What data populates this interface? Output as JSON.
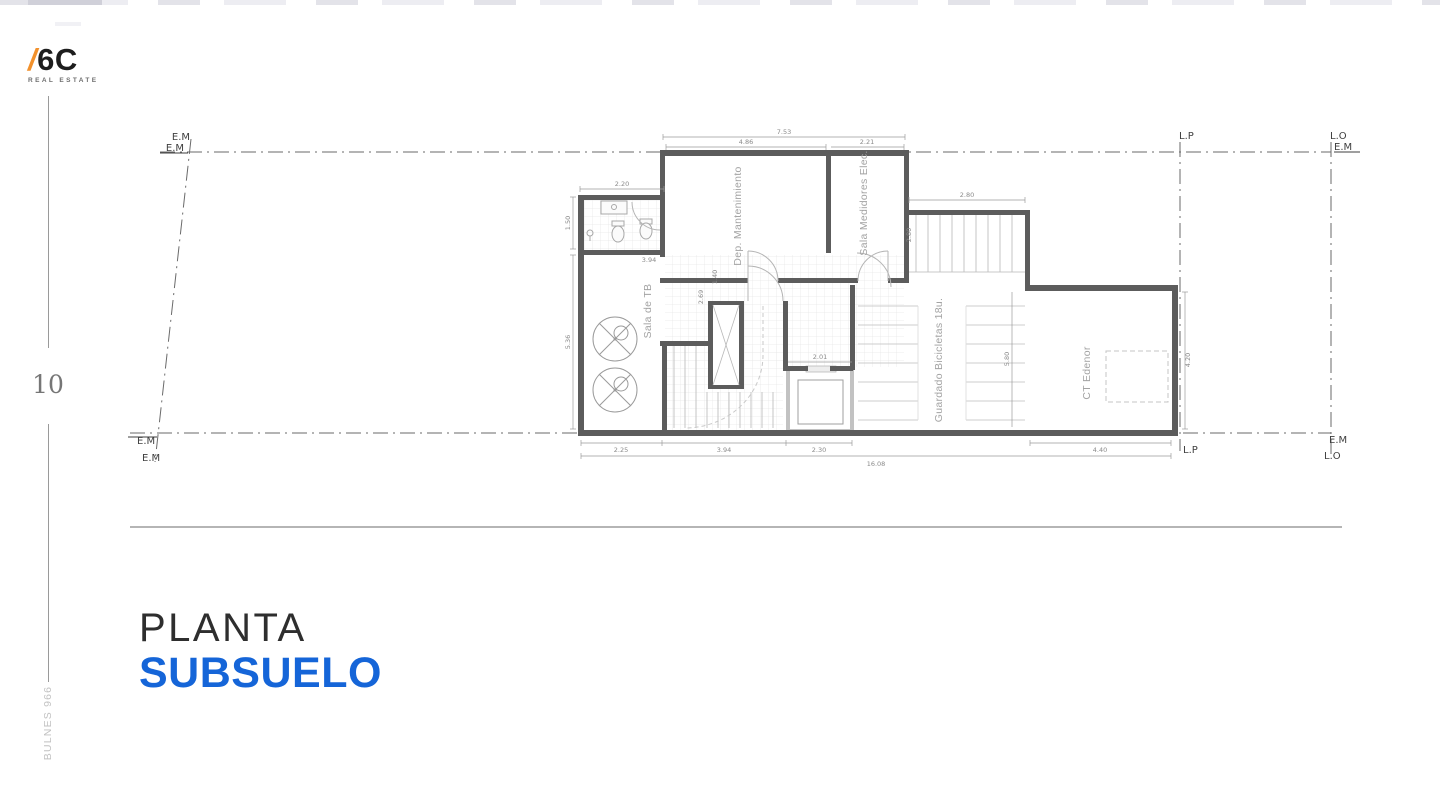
{
  "brand": {
    "slash": "/",
    "name": "6C",
    "tagline": "REAL ESTATE",
    "slash_color": "#F2912C"
  },
  "sidebar": {
    "page_number": "10",
    "project": "BULNES 966"
  },
  "title": {
    "line1": "PLANTA",
    "line2": "SUBSUELO",
    "accent_color": "#1565D8"
  },
  "plan": {
    "rooms": {
      "dep_mantenimiento": "Dep. Mantenimiento",
      "sala_medidores": "Sala Medidores Elec.",
      "sala_tb": "Sala de TB",
      "bicicletas": "Guardado Bicicletas 18u.",
      "ct_edenor": "CT Edenor"
    },
    "boundaries": {
      "em": "E.M",
      "lp": "L.P",
      "lo": "L.O"
    },
    "dimensions": {
      "top_total": "7.53",
      "top_left": "4.86",
      "top_right": "2.21",
      "bath_width": "2.20",
      "bath_height": "1.50",
      "bath_inner": "3.94",
      "tb_height": "5.36",
      "shaft_depth": "2.69",
      "hall_width": "1.40",
      "ramp_width": "2.80",
      "ramp_height": "2.80",
      "bike_height": "5.80",
      "elevator_width": "2.01",
      "ct_height": "4.20",
      "bottom_1": "2.25",
      "bottom_2": "3.94",
      "bottom_3": "2.30",
      "bottom_4": "4.40",
      "bottom_total": "16.08"
    },
    "wall_color": "#5C5C5C"
  }
}
